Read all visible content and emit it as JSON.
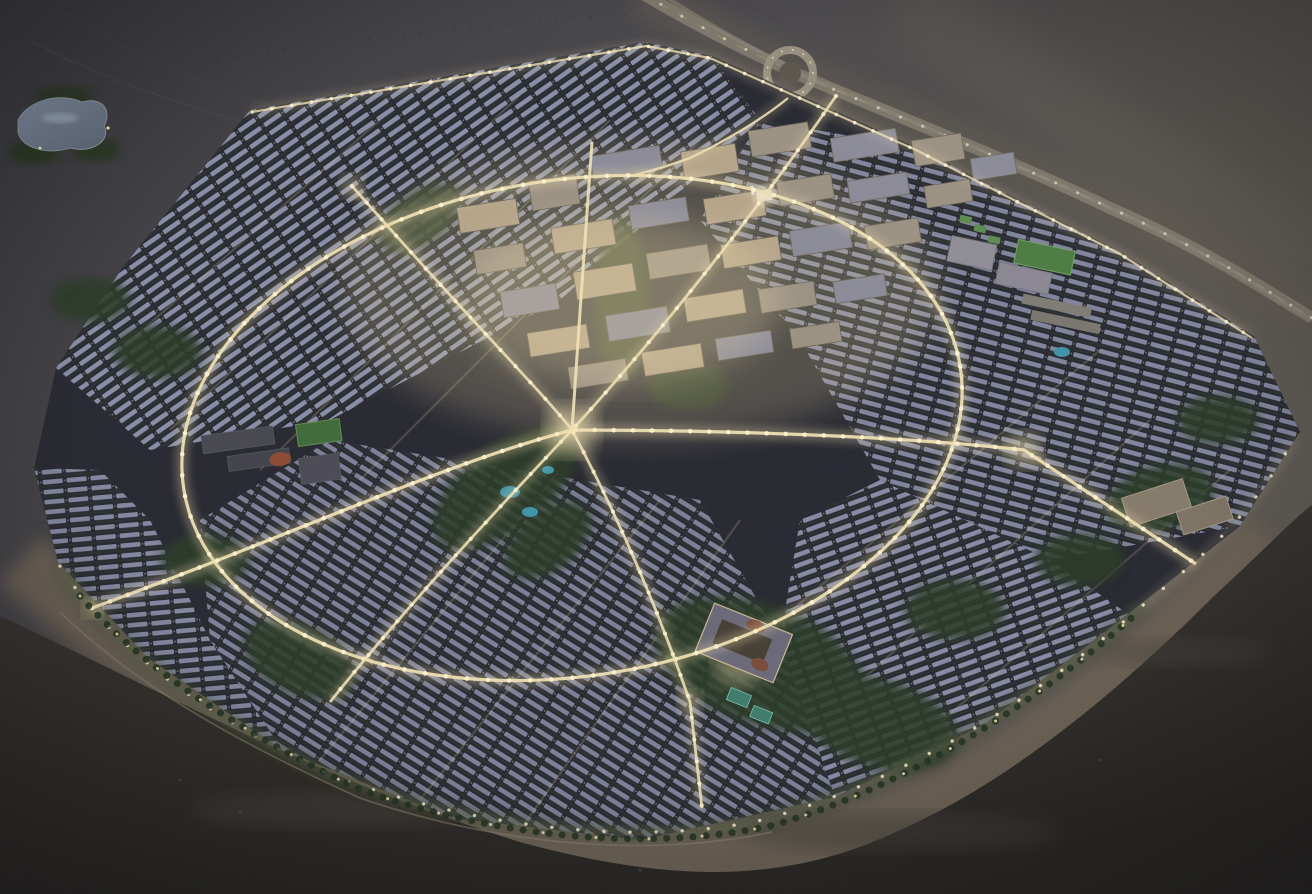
{
  "scene": {
    "description": "Aerial night render of a coastal master-planned community surrounded by desert and sea",
    "time_of_day": "dusk",
    "landmarks": [
      {
        "name": "ornamental-lake",
        "note": "small lake at north-west corner"
      },
      {
        "name": "desert-highway",
        "note": "highway with roundabout along north-east edge"
      },
      {
        "name": "highway-roundabout",
        "note": "lit roundabout at top"
      },
      {
        "name": "downtown-core",
        "note": "warm-lit mid-rise town centre north of plan centre"
      },
      {
        "name": "mosque",
        "note": "small white mosque with minaret in downtown"
      },
      {
        "name": "ring-road",
        "note": "illuminated oval ring road around the plan"
      },
      {
        "name": "central-crossing",
        "note": "bright X junction at the centre"
      },
      {
        "name": "linear-park",
        "note": "green corridor with pools south-west of centre"
      },
      {
        "name": "sports-fields",
        "note": "floodlit green pitches at north-east"
      },
      {
        "name": "school-campus-west",
        "note": "dark-roof campus with field on west side"
      },
      {
        "name": "resort-complex-south",
        "note": "large courtyard building with teal courts"
      },
      {
        "name": "campus-south-east",
        "note": "tan-roof campus near east shore"
      },
      {
        "name": "beachfront-park",
        "note": "winding paths and palms along shoreline"
      },
      {
        "name": "sea",
        "note": "dark water across south and west"
      },
      {
        "name": "villa-districts",
        "note": "dense rows of blue-grey villa rooftops"
      }
    ]
  },
  "palette": {
    "desertDark": "#38373c",
    "desertMid": "#49474b",
    "desertLight": "#57534e",
    "desertEdge": "#5d5852",
    "water": "#393632",
    "waterDeep": "#282623",
    "sand": "#6e6354",
    "plotBase": "#262730",
    "rooftop": "#8e93ac",
    "greenery": "#2c3a27",
    "field": "#4d7a43",
    "roadGlow": "#eedfb2",
    "lightDot": "#fff3cf",
    "downtownGlow": "#eed8a6",
    "downtownWall": "#b5a489",
    "asphalt": "#7e776a",
    "lakeLight": "#8795ab",
    "lakeDark": "#5f6a7a",
    "mosque": "#e8e4da",
    "pool": "#3f93a8"
  }
}
